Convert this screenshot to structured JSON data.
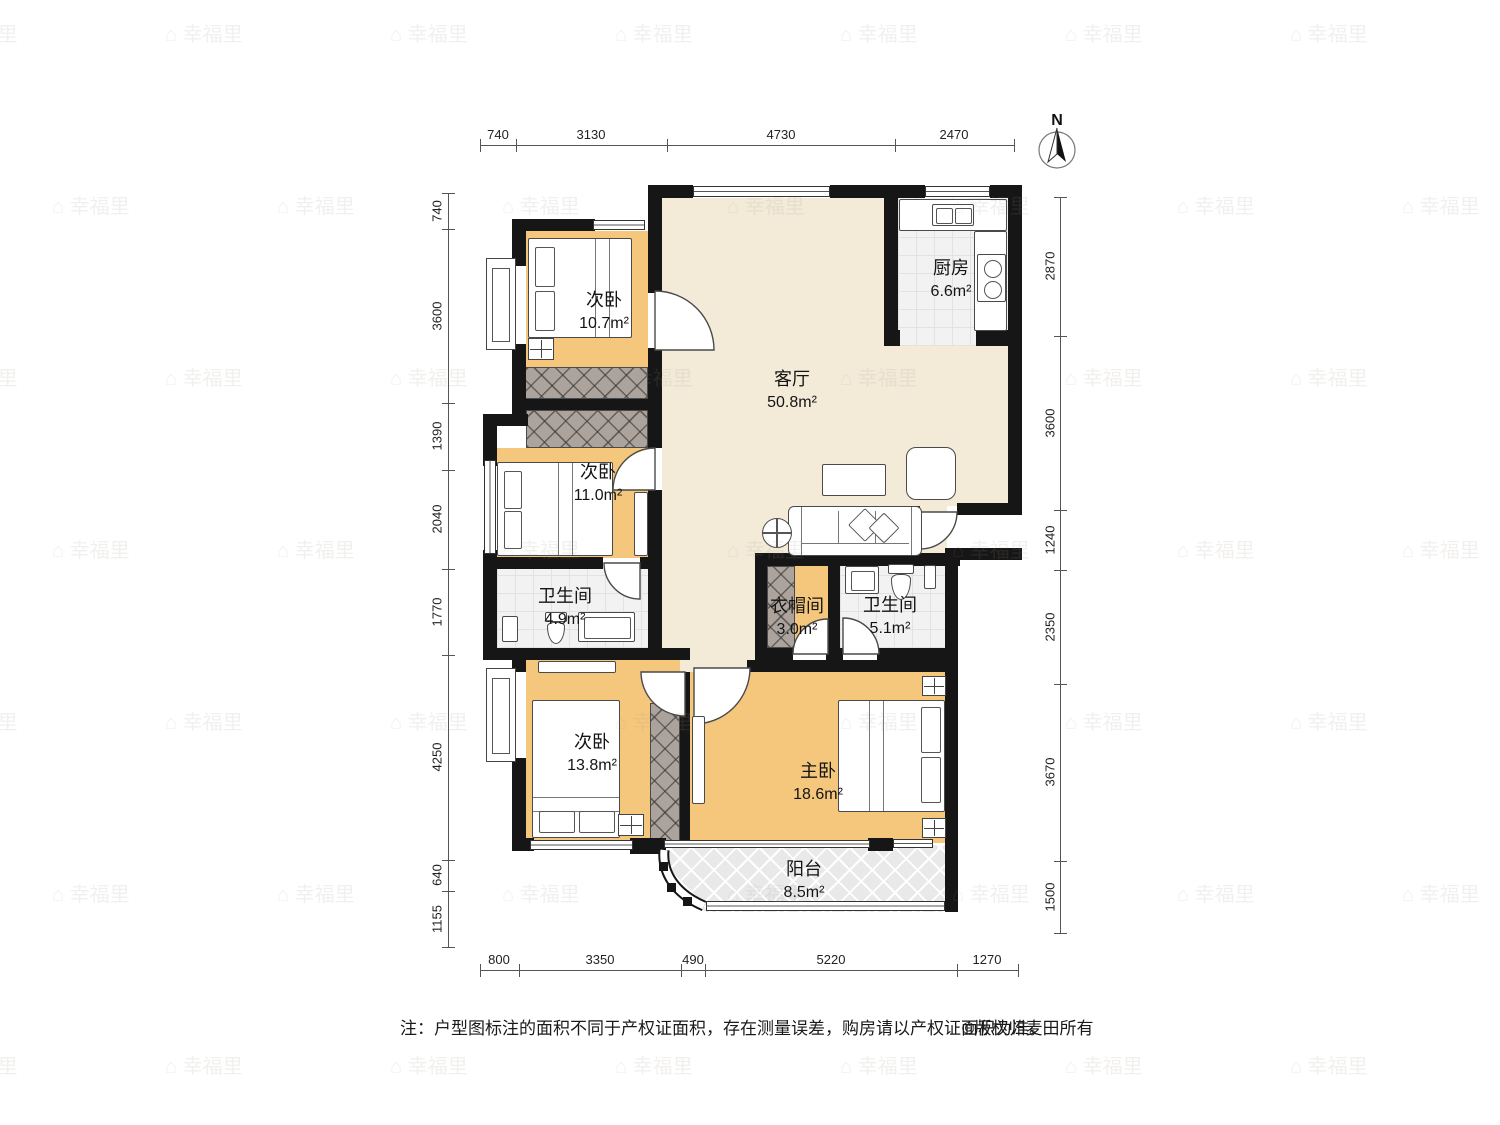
{
  "meta": {
    "north_label": "N"
  },
  "watermark": {
    "text": "⌂ 幸福里"
  },
  "rooms": {
    "bedroom1": {
      "name": "次卧",
      "area": "10.7m²"
    },
    "bedroom2": {
      "name": "次卧",
      "area": "11.0m²"
    },
    "bedroom3": {
      "name": "次卧",
      "area": "13.8m²"
    },
    "master": {
      "name": "主卧",
      "area": "18.6m²"
    },
    "living": {
      "name": "客厅",
      "area": "50.8m²"
    },
    "kitchen": {
      "name": "厨房",
      "area": "6.6m²"
    },
    "bath1": {
      "name": "卫生间",
      "area": "4.9m²"
    },
    "bath2": {
      "name": "卫生间",
      "area": "5.1m²"
    },
    "closet": {
      "name": "衣帽间",
      "area": "3.0m²"
    },
    "balcony": {
      "name": "阳台",
      "area": "8.5m²"
    }
  },
  "dims": {
    "top": [
      "740",
      "3130",
      "4730",
      "2470"
    ],
    "bottom": [
      "800",
      "3350",
      "490",
      "5220",
      "1270"
    ],
    "left": [
      "740",
      "3600",
      "1390",
      "2040",
      "1770",
      "4250",
      "640",
      "1155"
    ],
    "right": [
      "2870",
      "3600",
      "1240",
      "2350",
      "3670",
      "1500"
    ]
  },
  "note": {
    "text": "注：户型图标注的面积不同于产权证面积，存在测量误差，购房请以产权证面积为准。",
    "copyright": "©版权归麦田所有"
  },
  "colors": {
    "wall": "#161616",
    "wood": "#f4c77d",
    "beige": "#f3ebd8",
    "tile": "#f2f2f2"
  }
}
